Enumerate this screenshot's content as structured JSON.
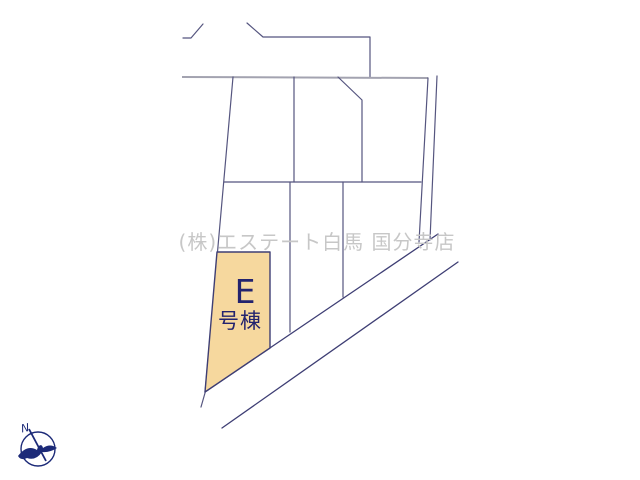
{
  "map": {
    "watermark": "(株)エステート白馬 国分寺店",
    "highlighted_unit": {
      "label": "E",
      "type_label": "号棟"
    },
    "compass": {
      "north_label": "N"
    },
    "colors": {
      "background": "#FFFFFF",
      "line": "#55557F",
      "road_line": "#3E3E74",
      "street_line": "#A3A3B0",
      "unit_fill": "#F6D89E",
      "unit_stroke": "#3E3E74",
      "unit_text": "#23236E",
      "watermark": "#C7C7C7",
      "compass": "#1C2A78"
    }
  }
}
